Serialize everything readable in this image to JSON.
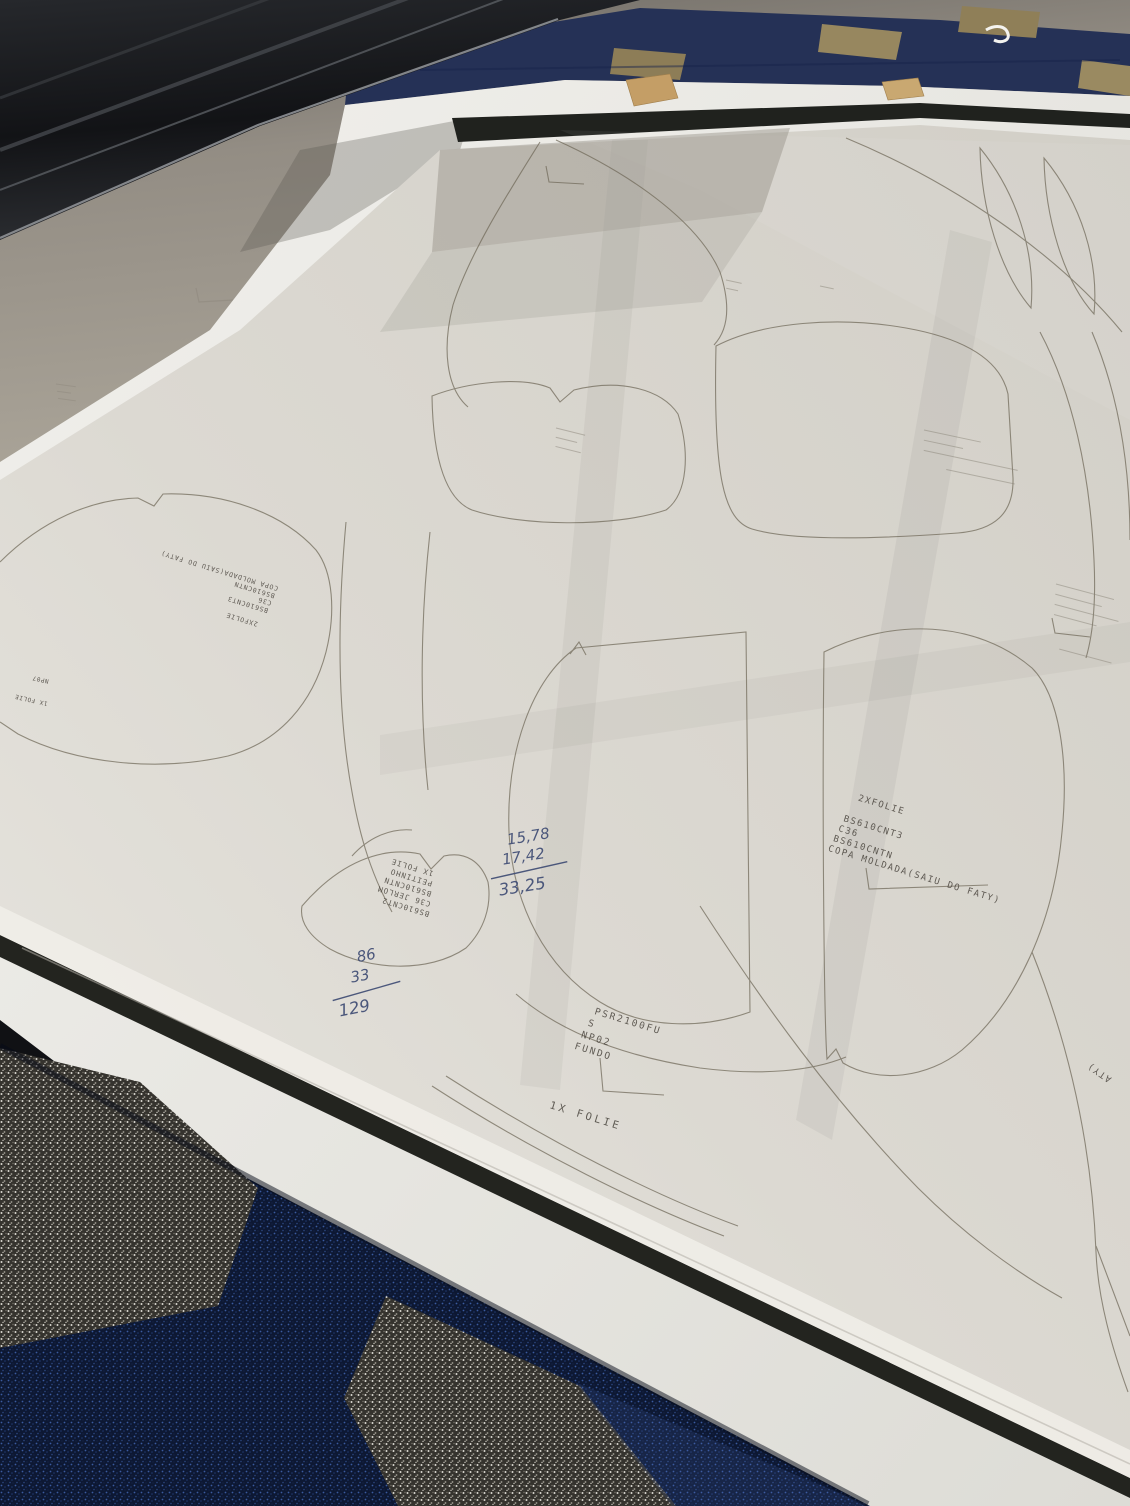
{
  "colors": {
    "machine_rail": "#1a1b1e",
    "floor_gray": "#a39d93",
    "carpet_top_navy": "#253156",
    "carpet_tile_tan": "#97875f",
    "fleece_white": "#e9e8e3",
    "edge_band_black": "#20221e",
    "cardboard_tan": "#c49e66",
    "paper": "#dcd9d2",
    "outline_ink": "#6f6858",
    "plotter_text": "#4a453e",
    "pen_ink_blue": "#3f4c74",
    "carpet_bottom_navy": "#0d1833",
    "carpet_bottom_gray": "#b9b7af"
  },
  "printed_labels": {
    "copa_right": {
      "lines": [
        "2XFOLIE",
        "BS610CNT3",
        "C36",
        "BS610CNTN",
        "COPA MOLDADA(SAIU DO FATY)"
      ]
    },
    "fundo_piece": {
      "lines": [
        "PSR2100FU",
        "S",
        "NP02",
        "FUNDO"
      ]
    },
    "folie_bottom": {
      "text": "1X FOLIE"
    },
    "peitinho": {
      "lines": [
        "BS610CNT2",
        "C36 JERLOM",
        "BS610CNTN",
        "PEITINHO",
        "1X FOLIE"
      ]
    },
    "copa_left": {
      "lines": [
        "2XFOLIE",
        "BS610CNT3",
        "C36",
        "BS610CNTN",
        "COPA MOLDADA(SAIU DO FATY)"
      ]
    },
    "left_edge": {
      "lines": [
        "1X FOLIE",
        "NP07"
      ]
    },
    "right_edge_partial": {
      "text": "ATY)"
    }
  },
  "handwriting": {
    "sum_top": {
      "addend1": "15,78",
      "addend2": "17,42",
      "total": "33,25"
    },
    "sum_bottom": {
      "addend1": "86",
      "addend2": "33",
      "total": "129"
    }
  }
}
